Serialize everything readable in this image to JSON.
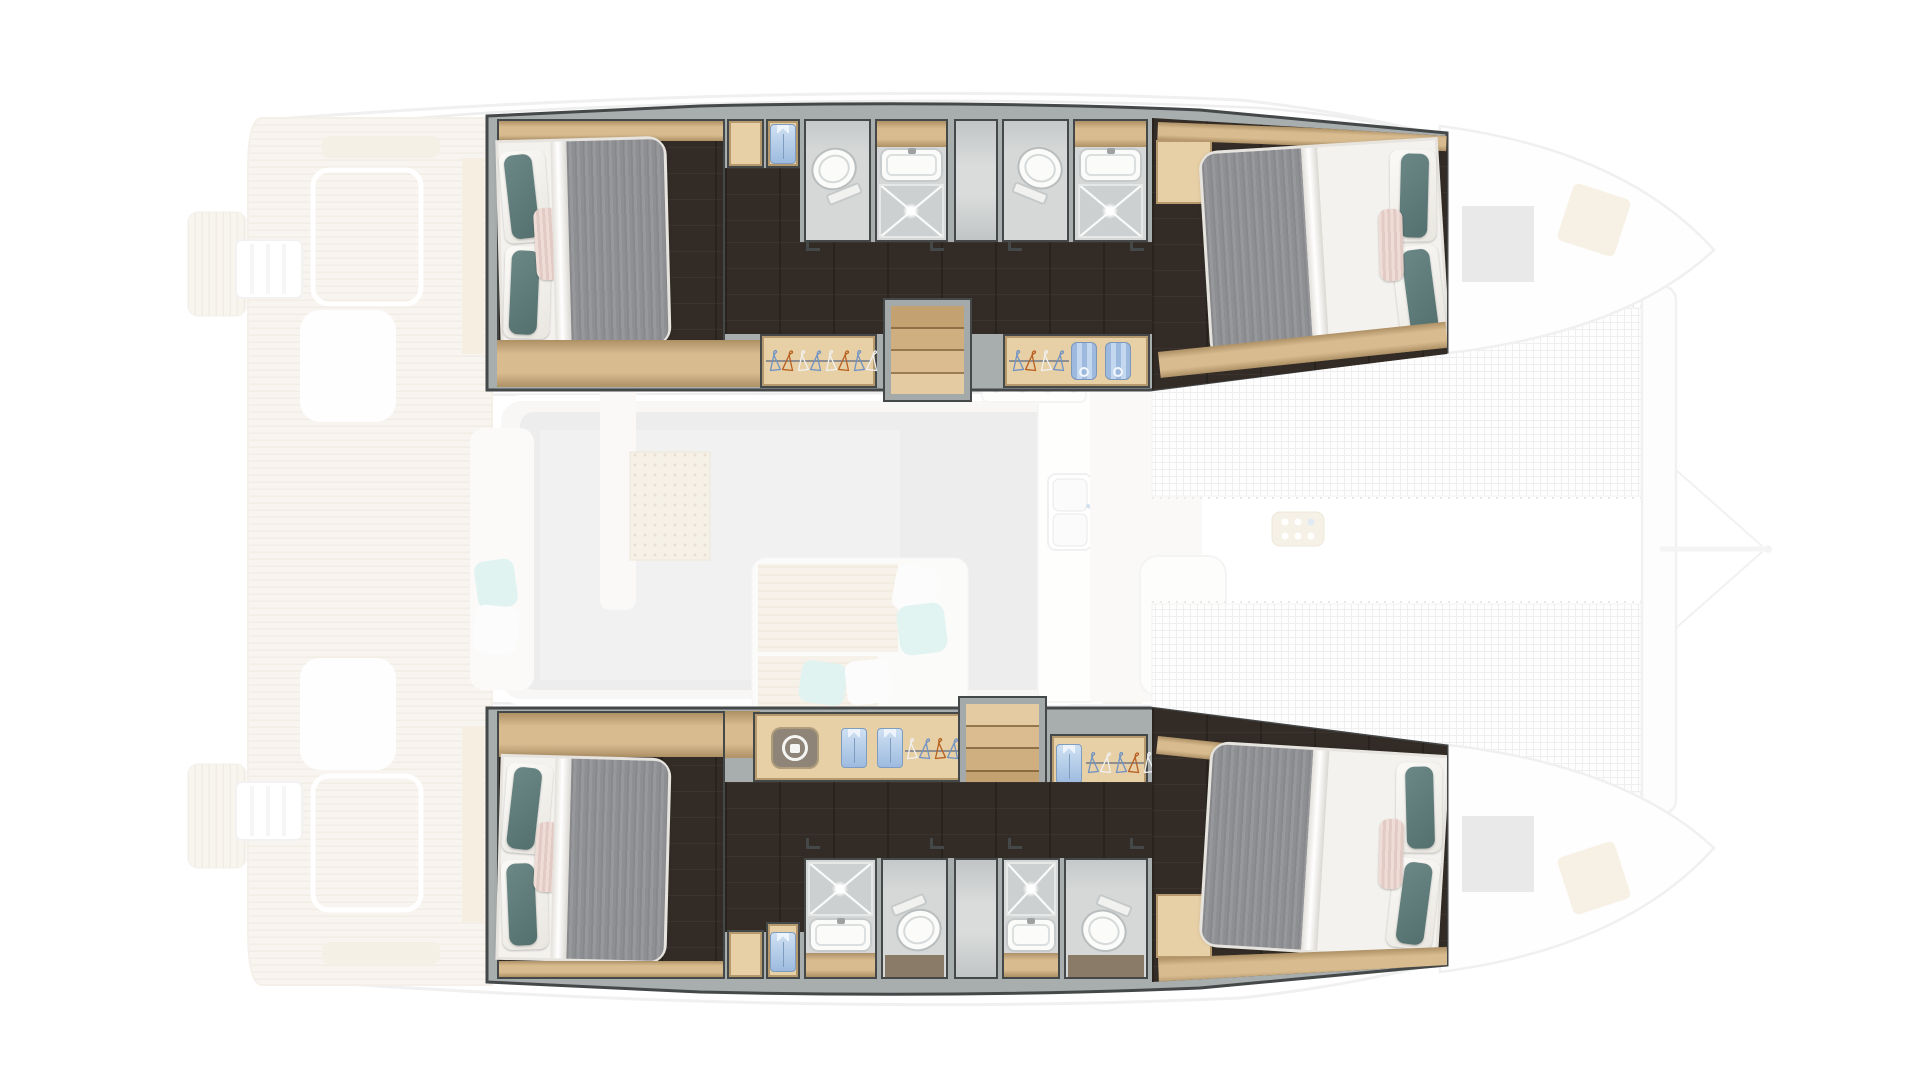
{
  "meta": {
    "view_label": "catamaran-deck-and-cabin-floor-plan",
    "canvas": {
      "width": 1920,
      "height": 1080
    }
  },
  "palette": {
    "css": {
      "--wall": "#a8adad",
      "--line": "#454848",
      "--floor-dark": "#332c26",
      "--wood": "#d8bc90",
      "--wood-lite": "#e7cfa6",
      "--bath": "#d6d8d8",
      "--shower": "#ccd0d0",
      "--bed-white": "#f4f2ee",
      "--duvet": "#8f9092",
      "--teal": "#5e7a78",
      "--pink": "#e9d4ce",
      "--shirt": "#b9d0ea"
    },
    "hanger_colors": {
      "white": "#f0f1f1",
      "blue": "#7193c4",
      "orange": "#b8601f"
    },
    "accents": {
      "teal_pillow": "#5e7a78",
      "aqua_throw": "#b7e6e2",
      "teak": "#f0e9dc"
    }
  },
  "wardrobes": {
    "port_aft_hangers": [
      "blue",
      "orange",
      "white",
      "blue",
      "white",
      "orange",
      "blue",
      "white"
    ],
    "port_fwd_hangers": [
      "blue",
      "orange",
      "white",
      "blue"
    ],
    "stbd_aft_hangers": [
      "white",
      "blue",
      "orange",
      "blue",
      "white"
    ],
    "stbd_fwd_hangers": [
      "blue",
      "white",
      "blue",
      "orange",
      "white"
    ]
  },
  "hulls": {
    "port": {
      "label": "port hull — two double cabins, two shower rooms, two toilet rooms, companionway stairs"
    },
    "starboard": {
      "label": "starboard hull — two double cabins, two shower rooms, two toilet rooms, washer unit, companionway stairs"
    }
  },
  "rooms": {
    "port_aft_cabin": {
      "label": "aft double cabin",
      "icons": [
        "double-bed-icon",
        "teal-pillow-icon"
      ]
    },
    "port_fwd_cabin": {
      "label": "forward double cabin",
      "icons": [
        "double-bed-icon",
        "teal-pillow-icon"
      ]
    },
    "stbd_aft_cabin": {
      "label": "aft double cabin",
      "icons": [
        "double-bed-icon",
        "teal-pillow-icon"
      ]
    },
    "stbd_fwd_cabin": {
      "label": "forward double cabin",
      "icons": [
        "double-bed-icon",
        "teal-pillow-icon"
      ]
    },
    "bathrooms": {
      "label": "en-suite shower room with toilet, basin, rain shower",
      "icons": [
        "toilet-icon",
        "sink-icon",
        "shower-icon",
        "ceiling-light-icon"
      ]
    },
    "wardrobe_items": [
      "hanger-icon",
      "folded-shirt-icon",
      "hanging-towel-icon",
      "washing-machine-icon"
    ],
    "deck_ghost": {
      "label": "main deck shown ghosted",
      "features": [
        "aft-cockpit",
        "teak-deck",
        "saloon",
        "galley-sink-icon",
        "stove-burners-icon",
        "chaise-lounge",
        "forward-cockpit",
        "trampoline-net",
        "bow-crossbeam",
        "deck-hatch"
      ]
    }
  }
}
